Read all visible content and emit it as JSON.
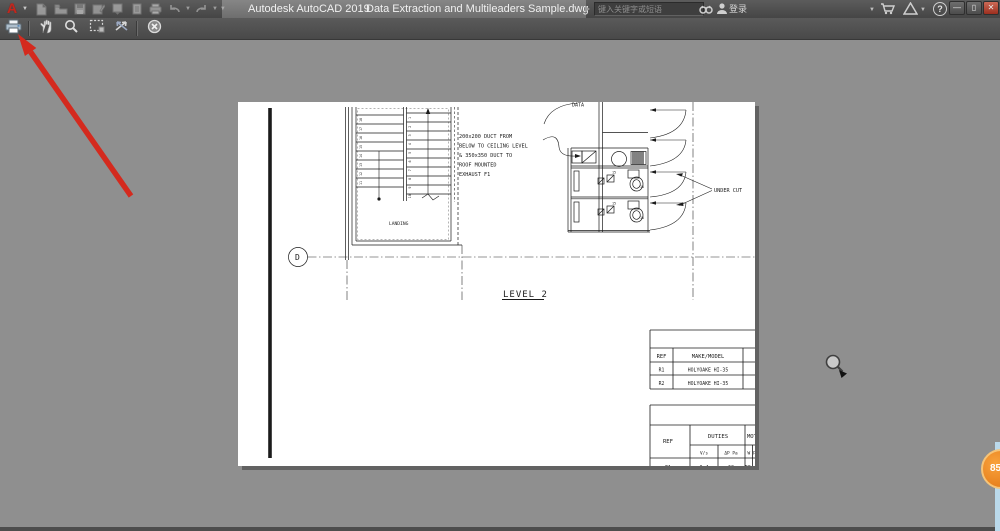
{
  "titlebar": {
    "logo": "A",
    "product": "Autodesk AutoCAD 2019",
    "document": "Data Extraction and Multileaders Sample.dwg",
    "search": {
      "placeholder": "键入关键字或短语"
    },
    "signin": "登录",
    "help": "?",
    "window_buttons": {
      "minimize": "—",
      "restore": "▯",
      "close": "✕"
    }
  },
  "quick_access_icons": [
    "new-file-icon",
    "open-folder-icon",
    "save-icon",
    "save-as-icon",
    "export-icon",
    "sheet-icon",
    "plot-icon",
    "undo-icon",
    "redo-icon",
    "toolbar-dropdown-icon"
  ],
  "preview_toolbar": {
    "buttons": [
      {
        "name": "plot",
        "icon": "printer-icon"
      },
      {
        "name": "pan",
        "icon": "hand-icon"
      },
      {
        "name": "zoom-realtime",
        "icon": "magnifier-icon"
      },
      {
        "name": "zoom-window",
        "icon": "zoom-window-icon"
      },
      {
        "name": "zoom-original",
        "icon": "zoom-original-icon"
      },
      {
        "name": "close-preview",
        "icon": "close-circle-icon"
      }
    ]
  },
  "drawing": {
    "grid_bubble": "D",
    "level_label": "LEVEL 2",
    "landing_label": "LANDING",
    "data_room_label": "DATA",
    "under_cut_label": "UNDER CUT",
    "duct_note": [
      "200x200 DUCT FROM",
      "BELOW TO CEILING LEVEL",
      "& 350x350 DUCT TO",
      "ROOF MOUNTED",
      "EXHAUST F1"
    ],
    "stair_numbers_left": [
      "11",
      "12",
      "13",
      "14",
      "15",
      "16",
      "17",
      "18"
    ],
    "stair_numbers_right": [
      "1",
      "2",
      "3",
      "4",
      "5",
      "6",
      "7",
      "8",
      "9",
      "10"
    ],
    "fixture_flow_labels": [
      "15",
      "15",
      "15",
      "15"
    ],
    "table1": {
      "header": [
        "REF",
        "MAKE/MODEL"
      ],
      "rows": [
        [
          "R1",
          "HOLYOAKE HI-35"
        ],
        [
          "R2",
          "HOLYOAKE HI-35"
        ]
      ]
    },
    "table2": {
      "ref_header": "REF",
      "duties_header": "DUTIES",
      "motor_header": "MOT",
      "sub_headers": [
        "V/s",
        "ΔP Pa",
        "W",
        "P"
      ],
      "clipped_row": [
        "F1",
        "0.4",
        "60",
        "55"
      ]
    }
  },
  "overlay": {
    "badge": "85"
  },
  "colors": {
    "annotation_arrow": "#d42a1e",
    "badge_orange": "#e8821e",
    "canvas_gray": "#8f8f8f",
    "titlebar_gray": "#4c4c4c",
    "paper_white": "#ffffff"
  }
}
